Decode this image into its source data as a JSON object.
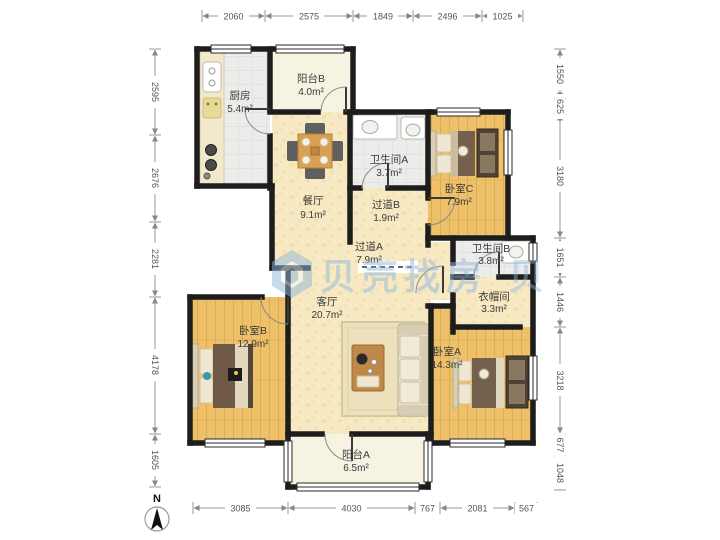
{
  "rooms": {
    "kitchen": {
      "name": "厨房",
      "area": "5.4m²"
    },
    "balcony_b": {
      "name": "阳台B",
      "area": "4.0m²"
    },
    "dining": {
      "name": "餐厅",
      "area": "9.1m²"
    },
    "bathroom_a": {
      "name": "卫生间A",
      "area": "3.7m²"
    },
    "corridor_b": {
      "name": "过道B",
      "area": "1.9m²"
    },
    "bedroom_c": {
      "name": "卧室C",
      "area": "7.9m²"
    },
    "corridor_a": {
      "name": "过道A",
      "area": "7.9m²"
    },
    "bathroom_b": {
      "name": "卫生间B",
      "area": "3.8m²"
    },
    "closet": {
      "name": "衣帽间",
      "area": "3.3m²"
    },
    "living": {
      "name": "客厅",
      "area": "20.7m²"
    },
    "bedroom_b": {
      "name": "卧室B",
      "area": "12.9m²"
    },
    "bedroom_a": {
      "name": "卧室A",
      "area": "14.3m²"
    },
    "balcony_a": {
      "name": "阳台A",
      "area": "6.5m²"
    }
  },
  "dimensions": {
    "top": [
      "2060",
      "2575",
      "1849",
      "2496",
      "1025"
    ],
    "bottom": [
      "3085",
      "4030",
      "767",
      "2081",
      "567"
    ],
    "left": [
      "2595",
      "2676",
      "2281",
      "4178",
      "1605"
    ],
    "right": [
      "1550",
      "625",
      "3180",
      "1651",
      "1446",
      "3218",
      "677",
      "1048"
    ]
  },
  "watermark": {
    "text": "贝壳找房",
    "partial": "贝"
  },
  "compass": {
    "label": "N"
  },
  "colors": {
    "wall": "#1d1d1d",
    "floor_yellow": "#f7e9c4",
    "floor_wood": "#eec06a",
    "floor_gray": "#ececeb",
    "floor_cream": "#f7f3e3",
    "watermark_blue": "#8fb8dd"
  }
}
